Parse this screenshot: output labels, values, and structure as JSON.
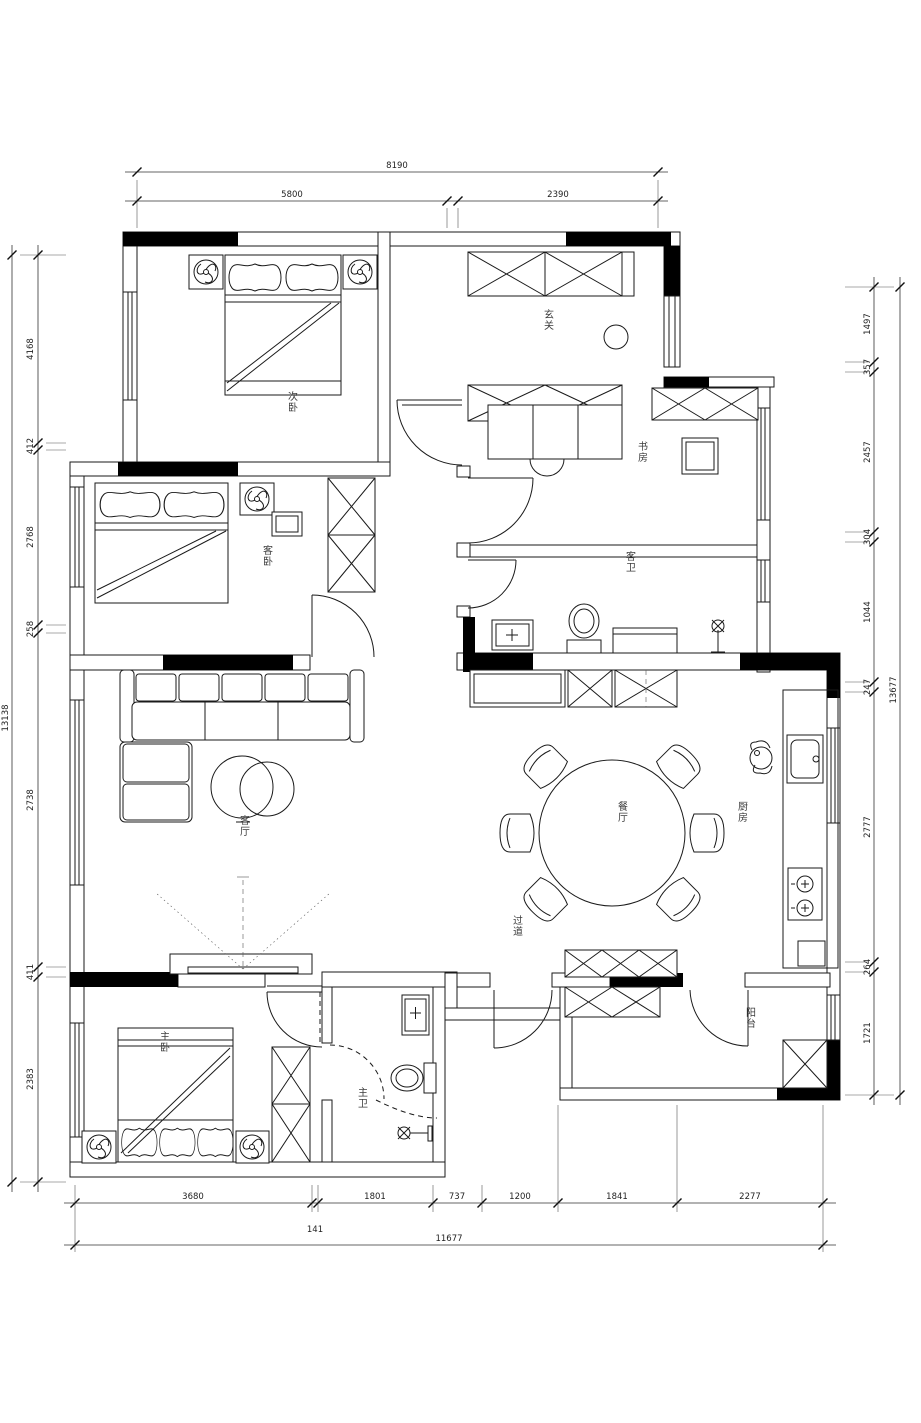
{
  "rooms": {
    "bedroom1": {
      "label": "次卧"
    },
    "entry": {
      "label": "玄关"
    },
    "study": {
      "label": "书房"
    },
    "guest_bath": {
      "label": "客卫"
    },
    "bedroom2": {
      "label": "客卧"
    },
    "living": {
      "label": "客厅"
    },
    "dining": {
      "label": "餐厅"
    },
    "kitchen": {
      "label": "厨房"
    },
    "hallway": {
      "label": "过道"
    },
    "master_bedroom": {
      "label": "主卧"
    },
    "master_bath": {
      "label": "主卫"
    },
    "balcony": {
      "label": "阳台"
    }
  },
  "dimensions": {
    "top": {
      "total": "8190",
      "segments": [
        "5800",
        "2390"
      ]
    },
    "bottom": {
      "segments": [
        "3680",
        "141",
        "1801",
        "737",
        "1200",
        "1841",
        "2277"
      ],
      "total": "11677"
    },
    "left": {
      "segments": [
        "4168",
        "412",
        "2768",
        "258",
        "2738",
        "411",
        "2383"
      ],
      "total": "13138"
    },
    "right": {
      "segments": [
        "1497",
        "357",
        "2457",
        "304",
        "1044",
        "247",
        "2777",
        "264",
        "1721"
      ],
      "total": "13677"
    }
  }
}
